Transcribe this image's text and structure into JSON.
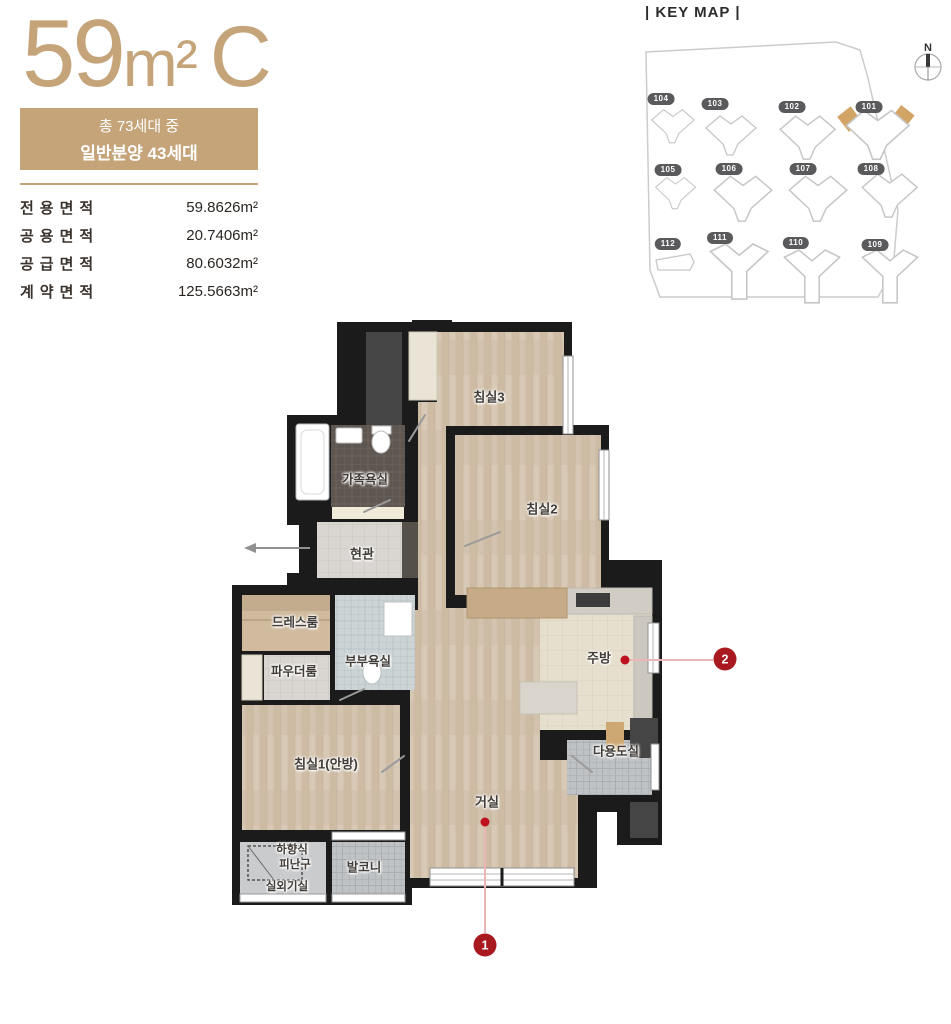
{
  "unit_summary": {
    "title_number": "59",
    "title_unit": "m²",
    "title_type": "C",
    "badge_line1": "총 73세대 중",
    "badge_line2": "일반분양 43세대"
  },
  "area_table": {
    "rows": [
      {
        "label": "전용면적",
        "value": "59.8626m²"
      },
      {
        "label": "공용면적",
        "value": "20.7406m²"
      },
      {
        "label": "공급면적",
        "value": "80.6032m²"
      },
      {
        "label": "계약면적",
        "value": "125.5663m²"
      }
    ]
  },
  "key_map": {
    "title": "| KEY MAP |",
    "compass": "N",
    "buildings": [
      {
        "id": "104"
      },
      {
        "id": "103"
      },
      {
        "id": "102"
      },
      {
        "id": "101",
        "highlighted": true
      },
      {
        "id": "105"
      },
      {
        "id": "106"
      },
      {
        "id": "107"
      },
      {
        "id": "108"
      },
      {
        "id": "112"
      },
      {
        "id": "111"
      },
      {
        "id": "110"
      },
      {
        "id": "109"
      }
    ]
  },
  "floor_plan": {
    "rooms": [
      {
        "id": "bedroom3",
        "label": "침실3"
      },
      {
        "id": "bedroom2",
        "label": "침실2"
      },
      {
        "id": "family-bathroom",
        "label": "가족욕실"
      },
      {
        "id": "entrance",
        "label": "현관"
      },
      {
        "id": "dressroom",
        "label": "드레스룸"
      },
      {
        "id": "powder-room",
        "label": "파우더룸"
      },
      {
        "id": "master-bathroom",
        "label": "부부욕실"
      },
      {
        "id": "kitchen",
        "label": "주방"
      },
      {
        "id": "utility-room",
        "label": "다용도실"
      },
      {
        "id": "bedroom1",
        "label": "침실1(안방)"
      },
      {
        "id": "living-room",
        "label": "거실"
      },
      {
        "id": "balcony",
        "label": "발코니"
      },
      {
        "id": "outdoor-unit-room",
        "label": "실외기실"
      }
    ],
    "evac_hatch": {
      "line1": "하향식",
      "line2": "피난구"
    }
  },
  "markers": [
    {
      "number": "1"
    },
    {
      "number": "2"
    }
  ],
  "colors": {
    "accent_tan": "#c5a47a",
    "marker_red": "#a81a20",
    "wall_black": "#1b1b1b",
    "highlight_tan": "#d2a566"
  }
}
